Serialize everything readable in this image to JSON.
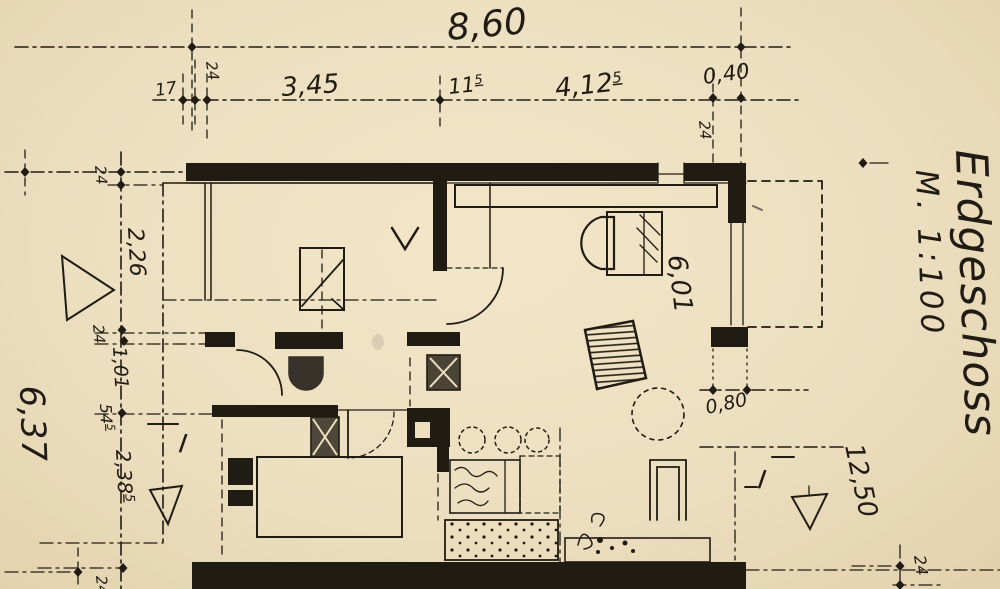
{
  "title": {
    "name": "Erdgeschoss",
    "scale": "M. 1:100"
  },
  "dims": {
    "top_total": "8,60",
    "top_chain": {
      "a17": "17",
      "a24": "24",
      "a345": "3,45",
      "a115_base": "11",
      "a115_sup": "5",
      "a4125_base": "4,12",
      "a4125_sup": "5",
      "a040": "0,40"
    },
    "wall24_top_right": "24",
    "left_chain": {
      "b24a": "24",
      "b226": "2,26",
      "b24b": "24",
      "b101": "1,01",
      "b545_base": "54",
      "b545_sup": "5",
      "b2385_base": "2,38",
      "b2385_sup": "5",
      "b24c": "24"
    },
    "left_total": "6,37",
    "room_width": "6,01",
    "right_080": "0,80",
    "right_1250": "12,50",
    "right_24": "24"
  },
  "section_markers": {
    "left": "I",
    "right": "I"
  },
  "colors": {
    "paper": "#eee0bf",
    "ink": "#211c13"
  }
}
